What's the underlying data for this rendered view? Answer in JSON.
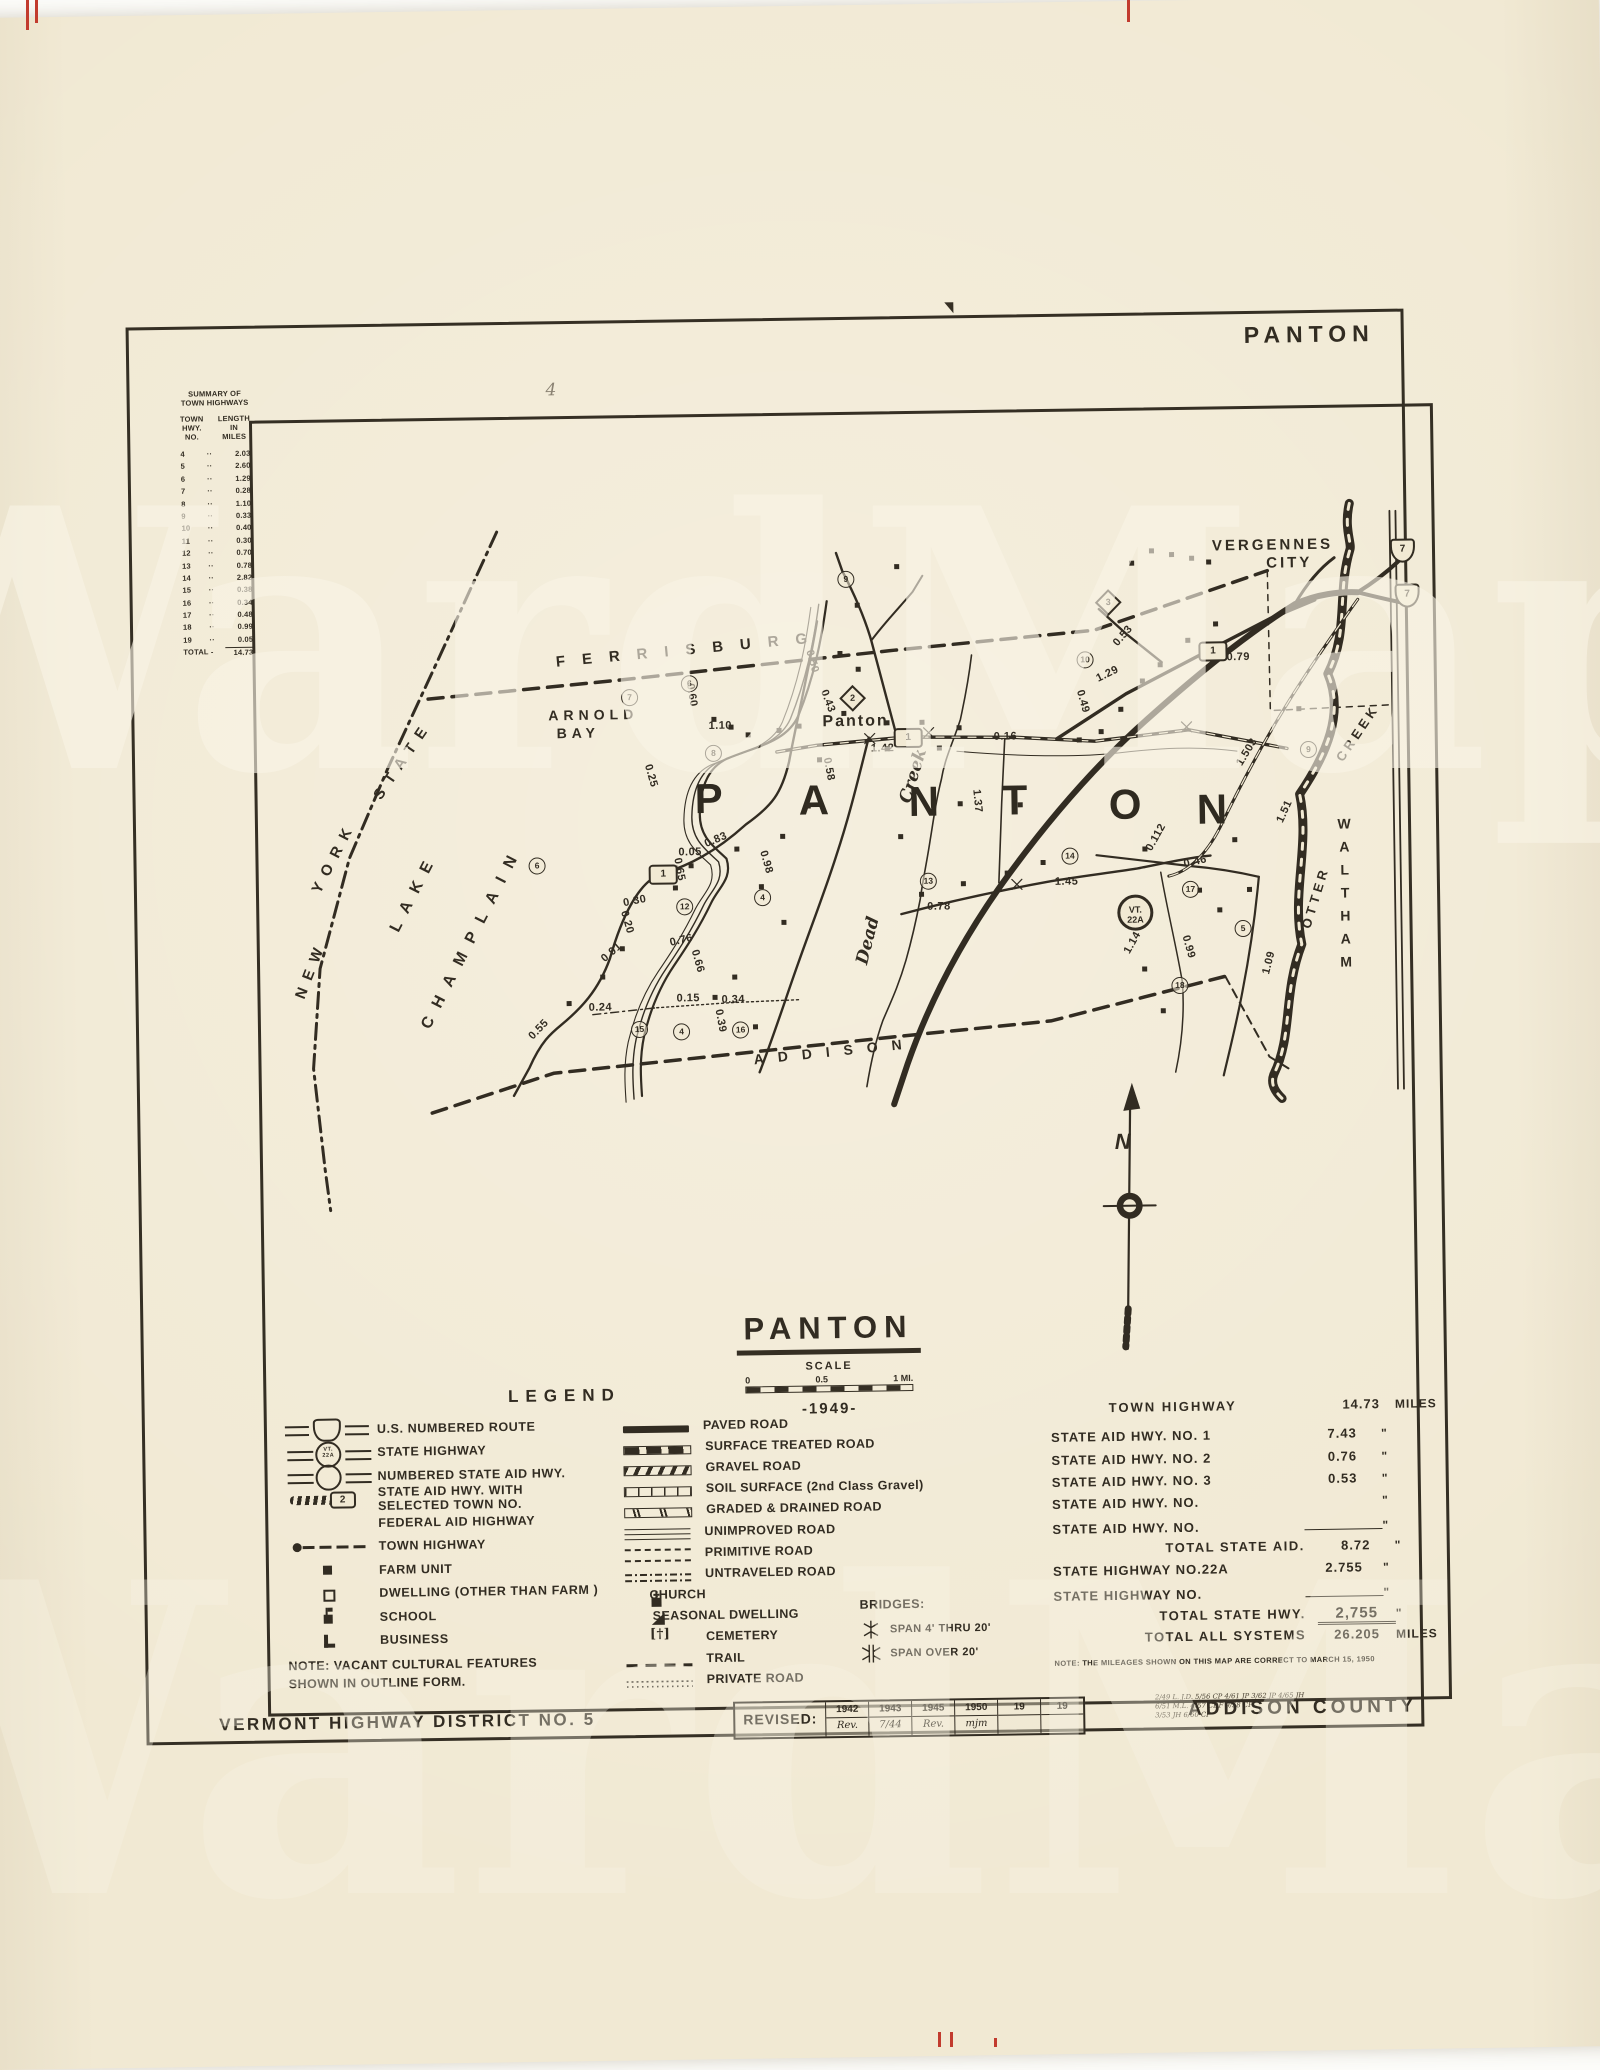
{
  "watermark": "WardMaps",
  "page": {
    "corner_title": "PANTON",
    "pencil_mark": "4"
  },
  "summary": {
    "title1": "SUMMARY OF",
    "title2": "TOWN HIGHWAYS",
    "col1": "TOWN HWY. NO.",
    "col2": "LENGTH IN MILES",
    "rows": [
      {
        "no": "4",
        "len": "2.03"
      },
      {
        "no": "5",
        "len": "2.60"
      },
      {
        "no": "6",
        "len": "1.29"
      },
      {
        "no": "7",
        "len": "0.28"
      },
      {
        "no": "8",
        "len": "1.10"
      },
      {
        "no": "9",
        "len": "0.33"
      },
      {
        "no": "10",
        "len": "0.40"
      },
      {
        "no": "11",
        "len": "0.30"
      },
      {
        "no": "12",
        "len": "0.70"
      },
      {
        "no": "13",
        "len": "0.78"
      },
      {
        "no": "14",
        "len": "2.82"
      },
      {
        "no": "15",
        "len": "0.38"
      },
      {
        "no": "16",
        "len": "0.34"
      },
      {
        "no": "17",
        "len": "0.48"
      },
      {
        "no": "18",
        "len": "0.99"
      },
      {
        "no": "19",
        "len": "0.05"
      }
    ],
    "total_label": "TOTAL -",
    "total": "14.73"
  },
  "map": {
    "labels": {
      "ferrisburg": "FERRISBURG",
      "addison": "ADDISON",
      "waltham": "WALTHAM",
      "vergennes1": "VERGENNES",
      "vergennes2": "CITY",
      "new1": "NEW",
      "new2": "YORK",
      "new3": "STATE",
      "lake": "LAKE",
      "champlain": "CHAMPLAIN",
      "arnold1": "ARNOLD",
      "arnold2": "BAY",
      "village": "Panton",
      "dead": "Dead",
      "dead_creek": "Creek",
      "otter": "OTTER",
      "otter_creek": "CREEK"
    },
    "compass_n": "N",
    "route22a": {
      "l1": "VT.",
      "l2": "22A",
      "x": 858,
      "y": 484
    },
    "town_letters": [
      {
        "t": "P",
        "x": 437,
        "y": 358
      },
      {
        "t": "A",
        "x": 541,
        "y": 361
      },
      {
        "t": "N",
        "x": 651,
        "y": 364
      },
      {
        "t": "T",
        "x": 744,
        "y": 364
      },
      {
        "t": "O",
        "x": 851,
        "y": 370
      },
      {
        "t": "N",
        "x": 939,
        "y": 376
      }
    ],
    "mileages": [
      {
        "t": "0.60",
        "x": 424,
        "y": 272,
        "rot": 82
      },
      {
        "t": "1.10",
        "x": 452,
        "y": 303
      },
      {
        "t": "1.42",
        "x": 614,
        "y": 328
      },
      {
        "t": "0.16",
        "x": 737,
        "y": 318
      },
      {
        "t": "0.50",
        "x": 545,
        "y": 240,
        "rot": 75
      },
      {
        "t": "0.43",
        "x": 560,
        "y": 280,
        "rot": 70
      },
      {
        "t": "0.58",
        "x": 560,
        "y": 348,
        "rot": 80
      },
      {
        "t": "0.55",
        "x": 266,
        "y": 604,
        "rot": -45
      },
      {
        "t": "0.30",
        "x": 364,
        "y": 477,
        "rot": -10
      },
      {
        "t": "0.20",
        "x": 356,
        "y": 498,
        "rot": 75
      },
      {
        "t": "0.91",
        "x": 340,
        "y": 528,
        "rot": -40
      },
      {
        "t": "0.24",
        "x": 328,
        "y": 583
      },
      {
        "t": "0.65",
        "x": 409,
        "y": 446,
        "rot": 80
      },
      {
        "t": "0.83",
        "x": 446,
        "y": 417,
        "rot": -22
      },
      {
        "t": "0.76",
        "x": 410,
        "y": 517,
        "rot": -12
      },
      {
        "t": "0.66",
        "x": 426,
        "y": 538,
        "rot": 75
      },
      {
        "t": "0.15",
        "x": 416,
        "y": 575
      },
      {
        "t": "0.34",
        "x": 461,
        "y": 577
      },
      {
        "t": "0.39",
        "x": 448,
        "y": 598,
        "rot": 80
      },
      {
        "t": "0.98",
        "x": 496,
        "y": 440,
        "rot": 75
      },
      {
        "t": "0.05",
        "x": 420,
        "y": 429
      },
      {
        "t": "0.25",
        "x": 382,
        "y": 352,
        "rot": 75
      },
      {
        "t": "0.78",
        "x": 668,
        "y": 487
      },
      {
        "t": "1.45",
        "x": 796,
        "y": 464
      },
      {
        "t": "1.37",
        "x": 708,
        "y": 382,
        "rot": 85
      },
      {
        "t": "1.29",
        "x": 840,
        "y": 257,
        "rot": -25
      },
      {
        "t": "0.53",
        "x": 856,
        "y": 219,
        "rot": -48
      },
      {
        "t": "0.79",
        "x": 971,
        "y": 242
      },
      {
        "t": "1.503",
        "x": 975,
        "y": 337,
        "rot": -58
      },
      {
        "t": "1.51",
        "x": 1015,
        "y": 397,
        "rot": -65
      },
      {
        "t": "0.112",
        "x": 883,
        "y": 421,
        "rot": -60
      },
      {
        "t": "1.14",
        "x": 861,
        "y": 526,
        "rot": -60
      },
      {
        "t": "0.99",
        "x": 917,
        "y": 531,
        "rot": 75
      },
      {
        "t": "1.09",
        "x": 997,
        "y": 548,
        "rot": -75
      },
      {
        "t": "0.46",
        "x": 925,
        "y": 446,
        "rot": -12
      },
      {
        "t": "0.49",
        "x": 815,
        "y": 284,
        "rot": 75
      }
    ],
    "circles": [
      {
        "t": "7",
        "x": 365,
        "y": 271
      },
      {
        "t": "6",
        "x": 425,
        "y": 258
      },
      {
        "t": "8",
        "x": 448,
        "y": 328
      },
      {
        "t": "9",
        "x": 583,
        "y": 156
      },
      {
        "t": "10",
        "x": 821,
        "y": 240
      },
      {
        "t": "12",
        "x": 417,
        "y": 481
      },
      {
        "t": "15",
        "x": 370,
        "y": 603
      },
      {
        "t": "16",
        "x": 471,
        "y": 605
      },
      {
        "t": "4",
        "x": 412,
        "y": 606
      },
      {
        "t": "4",
        "x": 495,
        "y": 473
      },
      {
        "t": "13",
        "x": 661,
        "y": 459
      },
      {
        "t": "14",
        "x": 803,
        "y": 436
      },
      {
        "t": "17",
        "x": 923,
        "y": 471
      },
      {
        "t": "18",
        "x": 911,
        "y": 567
      },
      {
        "t": "5",
        "x": 975,
        "y": 511
      },
      {
        "t": "9",
        "x": 1043,
        "y": 333
      },
      {
        "t": "6",
        "x": 270,
        "y": 438
      }
    ],
    "sa_boxes": [
      {
        "t": "1",
        "x": 637,
        "y": 314
      },
      {
        "t": "1",
        "x": 943,
        "y": 232
      },
      {
        "t": "1",
        "x": 390,
        "y": 447
      }
    ],
    "diamonds": [
      {
        "t": "2",
        "x": 587,
        "y": 274
      },
      {
        "t": "3",
        "x": 844,
        "y": 182
      }
    ],
    "us_shields": [
      {
        "t": "7",
        "x": 1136,
        "y": 132
      },
      {
        "t": "7",
        "x": 1140,
        "y": 177
      }
    ],
    "buildings": [
      {
        "x": 455,
        "y": 300
      },
      {
        "x": 472,
        "y": 308
      },
      {
        "x": 489,
        "y": 316
      },
      {
        "x": 520,
        "y": 312
      },
      {
        "x": 540,
        "y": 308
      },
      {
        "x": 585,
        "y": 296
      },
      {
        "x": 600,
        "y": 252
      },
      {
        "x": 582,
        "y": 236
      },
      {
        "x": 628,
        "y": 306
      },
      {
        "x": 663,
        "y": 306
      },
      {
        "x": 628,
        "y": 332
      },
      {
        "x": 680,
        "y": 332
      },
      {
        "x": 700,
        "y": 312
      },
      {
        "x": 560,
        "y": 342
      },
      {
        "x": 548,
        "y": 388
      },
      {
        "x": 522,
        "y": 418
      },
      {
        "x": 476,
        "y": 430
      },
      {
        "x": 430,
        "y": 446
      },
      {
        "x": 414,
        "y": 468
      },
      {
        "x": 360,
        "y": 528
      },
      {
        "x": 340,
        "y": 556
      },
      {
        "x": 306,
        "y": 582
      },
      {
        "x": 500,
        "y": 468
      },
      {
        "x": 522,
        "y": 504
      },
      {
        "x": 472,
        "y": 558
      },
      {
        "x": 452,
        "y": 578
      },
      {
        "x": 492,
        "y": 608
      },
      {
        "x": 660,
        "y": 478
      },
      {
        "x": 702,
        "y": 468
      },
      {
        "x": 746,
        "y": 458
      },
      {
        "x": 782,
        "y": 448
      },
      {
        "x": 862,
        "y": 296
      },
      {
        "x": 884,
        "y": 268
      },
      {
        "x": 902,
        "y": 252
      },
      {
        "x": 930,
        "y": 228
      },
      {
        "x": 958,
        "y": 212
      },
      {
        "x": 884,
        "y": 436
      },
      {
        "x": 938,
        "y": 478
      },
      {
        "x": 958,
        "y": 498
      },
      {
        "x": 882,
        "y": 556
      },
      {
        "x": 900,
        "y": 598
      },
      {
        "x": 988,
        "y": 478
      },
      {
        "x": 974,
        "y": 428
      },
      {
        "x": 1040,
        "y": 298
      },
      {
        "x": 820,
        "y": 326
      },
      {
        "x": 842,
        "y": 318
      },
      {
        "x": 895,
        "y": 138
      },
      {
        "x": 915,
        "y": 142
      },
      {
        "x": 935,
        "y": 146
      },
      {
        "x": 952,
        "y": 150
      },
      {
        "x": 875,
        "y": 150
      },
      {
        "x": 640,
        "y": 150
      },
      {
        "x": 600,
        "y": 188
      },
      {
        "x": 700,
        "y": 388
      },
      {
        "x": 760,
        "y": 390
      },
      {
        "x": 640,
        "y": 420
      }
    ]
  },
  "title_block": {
    "title": "PANTON",
    "scale_label": "SCALE",
    "tick0": "0",
    "tick1": "0.5",
    "tick2": "1 MI.",
    "year": "-1949-"
  },
  "legend": {
    "title": "LEGEND",
    "left": [
      {
        "label": "U.S. NUMBERED ROUTE",
        "sym": "us"
      },
      {
        "label": "STATE HIGHWAY",
        "sym": "sh",
        "sym_text": "VT. 22A"
      },
      {
        "label": "NUMBERED STATE AID HWY.",
        "sym": "sa"
      },
      {
        "label": "STATE AID HWY. WITH",
        "label2": "SELECTED TOWN NO.",
        "sym": "satown",
        "sym_text": "2"
      },
      {
        "label": "FEDERAL AID HIGHWAY",
        "sym": "fed"
      },
      {
        "label": "TOWN HIGHWAY",
        "sym": "town"
      },
      {
        "label": "FARM UNIT",
        "sym": "farm"
      },
      {
        "label": "DWELLING (OTHER THAN FARM )",
        "sym": "dwell"
      },
      {
        "label": "SCHOOL",
        "sym": "school"
      },
      {
        "label": "BUSINESS",
        "sym": "biz"
      }
    ],
    "note1": "NOTE: VACANT CULTURAL FEATURES",
    "note2": "SHOWN IN OUTLINE FORM.",
    "middle": [
      {
        "label": "PAVED ROAD",
        "sym": "paved"
      },
      {
        "label": "SURFACE TREATED ROAD",
        "sym": "surf"
      },
      {
        "label": "GRAVEL ROAD",
        "sym": "gravel"
      },
      {
        "label": "SOIL SURFACE (2nd Class Gravel)",
        "sym": "soil"
      },
      {
        "label": "GRADED & DRAINED ROAD",
        "sym": "graded"
      },
      {
        "label": "UNIMPROVED ROAD",
        "sym": "unimp"
      },
      {
        "label": "PRIMITIVE ROAD",
        "sym": "prim"
      },
      {
        "label": "UNTRAVELED ROAD",
        "sym": "untrav"
      },
      {
        "label": "CHURCH",
        "sym": "church"
      },
      {
        "label": "SEASONAL DWELLING",
        "sym": "seasonal"
      },
      {
        "label": "CEMETERY",
        "sym": "cem"
      },
      {
        "label": "TRAIL",
        "sym": "trail"
      },
      {
        "label": "PRIVATE ROAD",
        "sym": "priv"
      }
    ],
    "bridges_header": "BRIDGES:",
    "bridge1": "SPAN  4'  THRU  20'",
    "bridge2": "SPAN  OVER  20'"
  },
  "stats": {
    "rows": [
      {
        "label": "TOWN HIGHWAY",
        "value": "14.73",
        "unit": "MILES",
        "cls": "head"
      },
      {
        "label": "STATE AID HWY. NO. 1",
        "value": "7.43",
        "unit": "\""
      },
      {
        "label": "STATE AID HWY. NO. 2",
        "value": "0.76",
        "unit": "\""
      },
      {
        "label": "STATE AID HWY. NO. 3",
        "value": "0.53",
        "unit": "\""
      },
      {
        "label": "STATE AID HWY. NO.",
        "value": "",
        "unit": "\""
      },
      {
        "label": "STATE AID HWY. NO.",
        "value": "",
        "unit": "\"",
        "cls": "blankline"
      },
      {
        "label": "TOTAL STATE AID.",
        "value": "8.72",
        "unit": "\"",
        "cls": "tot"
      },
      {
        "label": "STATE HIGHWAY NO.22A",
        "value": "2.755",
        "unit": "\""
      },
      {
        "label": "STATE HIGHWAY NO.",
        "value": "",
        "unit": "\"",
        "cls": "blankline"
      },
      {
        "label": "TOTAL STATE HWY.",
        "value": "2,755",
        "unit": "\"",
        "cls": "tot undl"
      },
      {
        "label": "TOTAL ALL SYSTEMS",
        "value": "26.205",
        "unit": "MILES",
        "cls": "tot"
      }
    ],
    "note": "NOTE: THE MILEAGES SHOWN ON THIS MAP ARE CORRECT TO MARCH 15, 1950"
  },
  "footer": {
    "district": "VERMONT HIGHWAY DISTRICT NO. 5",
    "revised_label": "REVISED:",
    "cells": [
      {
        "top": "1942",
        "bottom": "Rev."
      },
      {
        "top": "1943",
        "bottom": "7/44"
      },
      {
        "top": "1945",
        "bottom": "Rev."
      },
      {
        "top": "1950",
        "bottom": "mjm"
      },
      {
        "top": "19",
        "bottom": ""
      },
      {
        "top": "19",
        "bottom": ""
      }
    ],
    "ann1": "2/49 L. J.D.   5/56 CP   4/61 JP   3/62 JP   4/65 JH",
    "ann2": "6/51 M.L.   4/57 CDF   9/58 CP",
    "ann3": "3/53 JH   6/60 CP",
    "county": "ADDISON COUNTY"
  }
}
